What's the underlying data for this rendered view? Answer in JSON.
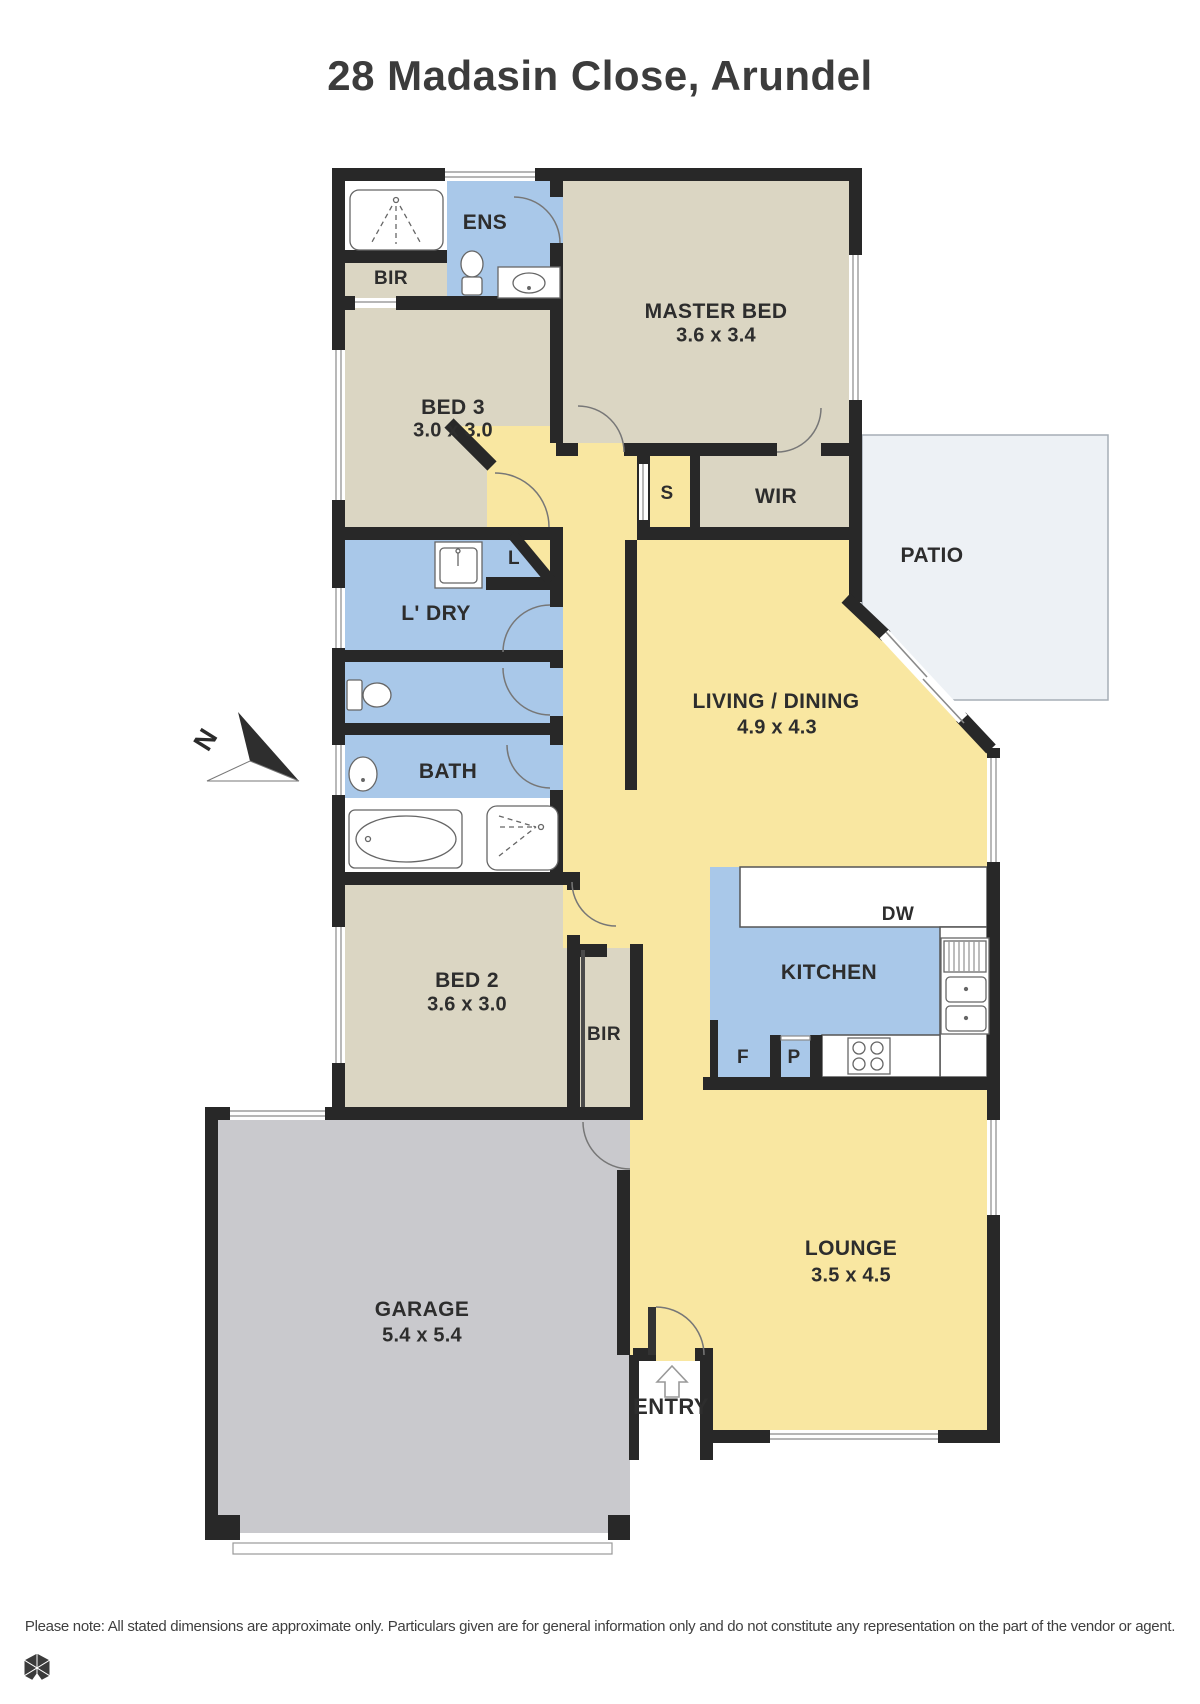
{
  "title": "28 Madasin Close, Arundel",
  "north_label": "N",
  "disclaimer": "Please note: All stated dimensions are approximate only. Particulars given are for general information only and do not constitute any representation on the part of the vendor or agent.",
  "colors": {
    "wall": "#282828",
    "room_beige": "#dbd6c3",
    "room_blue": "#a9c8e9",
    "room_yellow": "#f9e7a1",
    "garage_gray": "#c9c9cd",
    "patio_fill": "#edf1f5",
    "label_text": "#2d2d2d"
  },
  "rooms": [
    {
      "name": "ENS",
      "dims": ""
    },
    {
      "name": "BIR",
      "dims": ""
    },
    {
      "name": "MASTER BED",
      "dims": "3.6 x 3.4"
    },
    {
      "name": "BED 3",
      "dims": "3.0 x 3.0"
    },
    {
      "name": "S",
      "dims": ""
    },
    {
      "name": "WIR",
      "dims": ""
    },
    {
      "name": "PATIO",
      "dims": ""
    },
    {
      "name": "L",
      "dims": ""
    },
    {
      "name": "L' DRY",
      "dims": ""
    },
    {
      "name": "BATH",
      "dims": ""
    },
    {
      "name": "LIVING / DINING",
      "dims": "4.9 x 4.3"
    },
    {
      "name": "KITCHEN",
      "dims": ""
    },
    {
      "name": "DW",
      "dims": ""
    },
    {
      "name": "F",
      "dims": ""
    },
    {
      "name": "P",
      "dims": ""
    },
    {
      "name": "BED 2",
      "dims": "3.6 x 3.0"
    },
    {
      "name": "BIR",
      "dims": ""
    },
    {
      "name": "GARAGE",
      "dims": "5.4 x 5.4"
    },
    {
      "name": "LOUNGE",
      "dims": "3.5 x 4.5"
    },
    {
      "name": "ENTRY",
      "dims": ""
    }
  ]
}
